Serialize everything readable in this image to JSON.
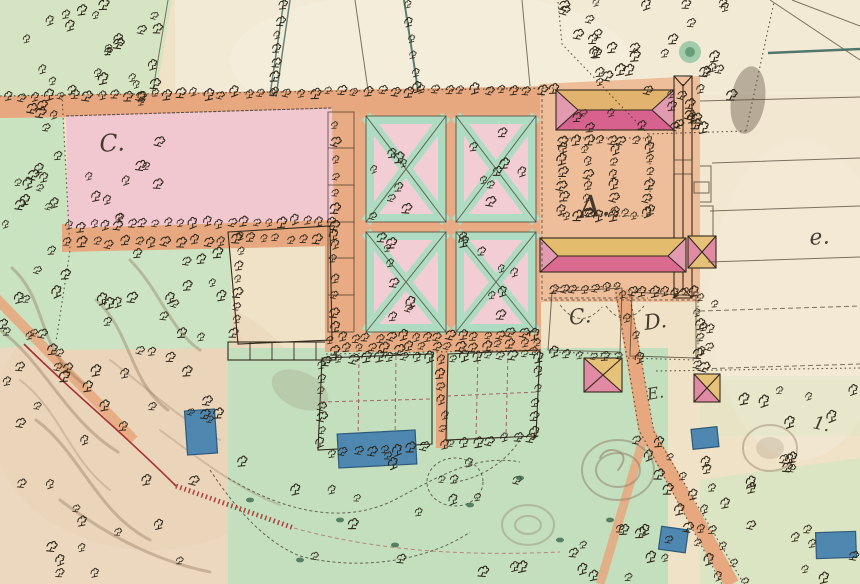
{
  "map": {
    "kind": "hand-drawn estate plan (historical cadastral map)",
    "labels": {
      "upper_meadow": "C.",
      "manor_house": "A.",
      "yard_left": "C.",
      "yard_right": "D.",
      "stable_yard": "E.",
      "field_script_e": "e.",
      "field_number_one": "1."
    },
    "features": {
      "pond": "blue rectangular pond",
      "tree": "deciduous tree symbol",
      "parterre": "formal garden with diagonal paths",
      "manor": "manor building complex with hipped roofs",
      "road": "tree-lined avenue",
      "boundary": "red surveyed boundary line"
    },
    "colors": {
      "parchment": "#efe2c6",
      "field_cream": "#f3ead6",
      "woodland_green": "#d5e5c3",
      "park_green": "#c9e2c0",
      "meadow_green": "#c3dfbe",
      "garden_green": "#aedcc2",
      "path_salmon": "#e7a87f",
      "courtyard_salmon": "#eebe9a",
      "parcel_pink": "#f2c8d0",
      "parcel_pale_pink": "#f7dcd8",
      "roof_pink": "#d8628e",
      "roof_rose": "#e27b9e",
      "roof_yellow": "#e3bc6d",
      "pond_blue": "#4e87b0",
      "ink": "#2e2619",
      "boundary_red": "#a83232",
      "terrain_brown": "#8b745a",
      "tree_road_teal": "#3f6a62"
    }
  }
}
